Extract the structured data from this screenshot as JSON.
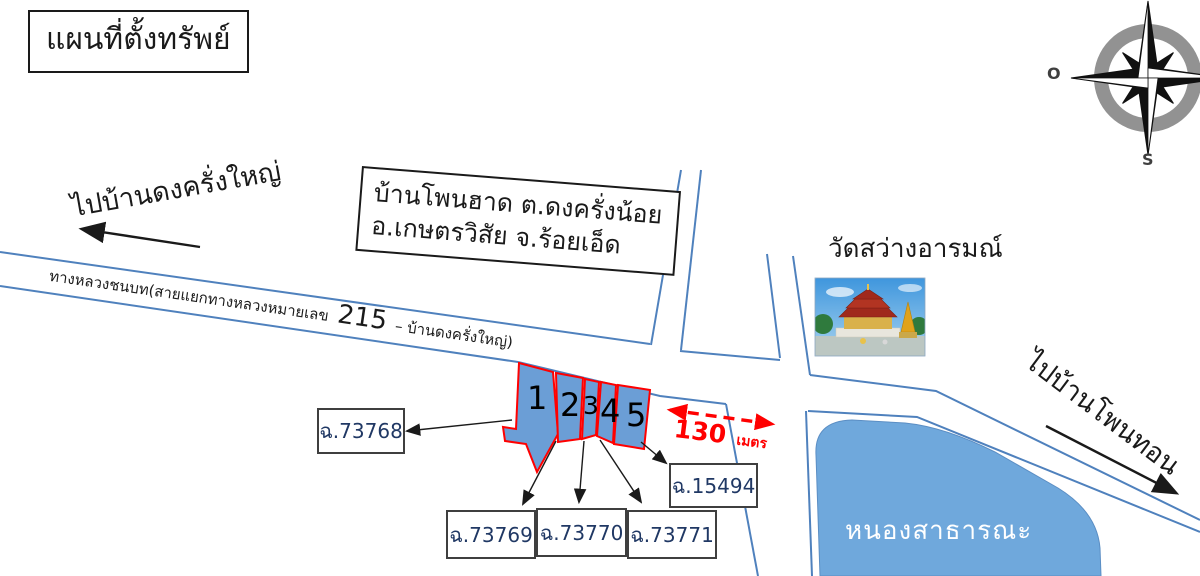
{
  "title": "แผนที่ตั้งทรัพย์",
  "compass": {
    "west_label": "O",
    "south_label": "S"
  },
  "directions": {
    "left": "ไปบ้านดงครั่งใหญ่",
    "right": "ไปบ้านโพนทอน"
  },
  "road_label": {
    "prefix": "ทางหลวงชนบท(สายแยกทางหลวงหมายเลข",
    "highway_number": "215",
    "suffix": "– บ้านดงครั่งใหญ่)"
  },
  "info_box": {
    "line1": "บ้านโพนฮาด ต.ดงครั่งน้อย",
    "line2": "อ.เกษตรวิสัย จ.ร้อยเอ็ด"
  },
  "temple": {
    "name": "วัดสว่างอารมณ์"
  },
  "pond": {
    "name": "หนองสาธารณะ"
  },
  "distance": {
    "value": "130",
    "unit": "เมตร"
  },
  "parcels": [
    {
      "number": "1",
      "deed": "ฉ.73768"
    },
    {
      "number": "2",
      "deed": "ฉ.73769"
    },
    {
      "number": "3",
      "deed": "ฉ.73770"
    },
    {
      "number": "4",
      "deed": "ฉ.73771"
    },
    {
      "number": "5",
      "deed": "ฉ.15494"
    }
  ],
  "colors": {
    "road_line": "#4f81bd",
    "parcel_fill": "#6b9ed6",
    "parcel_border": "#ff0000",
    "pond_fill": "#6fa8dc",
    "distance_red": "#ff0000"
  }
}
